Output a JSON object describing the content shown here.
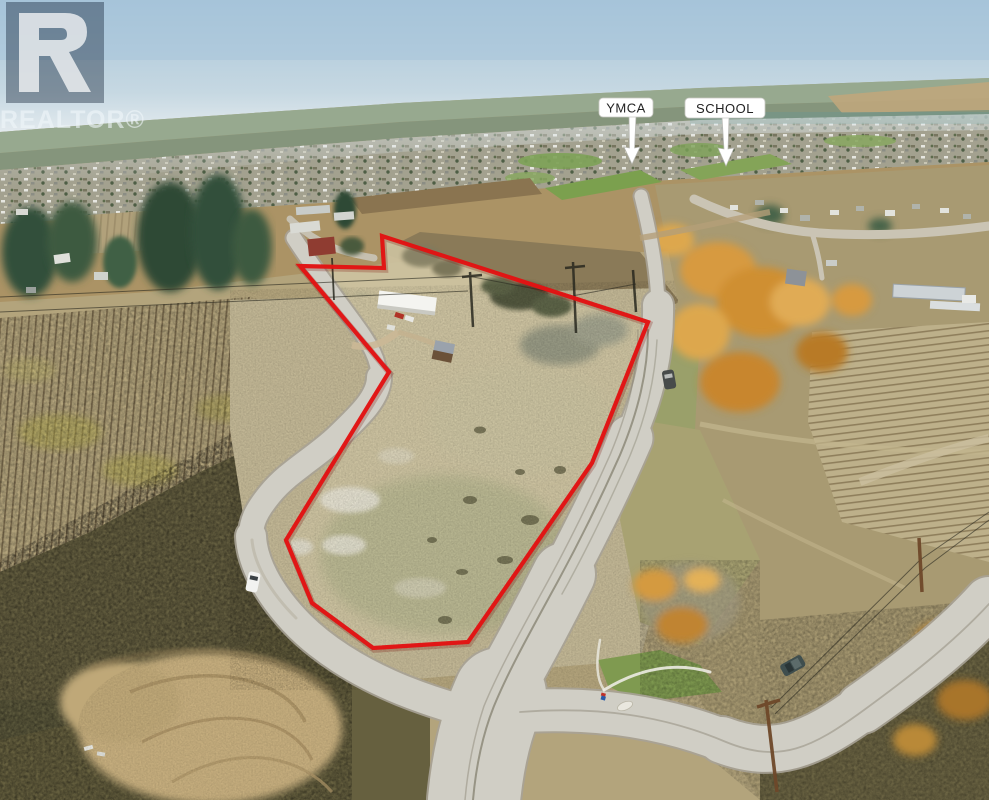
{
  "watermark": {
    "letter_icon": "realtor-R",
    "wordmark": "REALTOR®",
    "overlay_color": "#14283c",
    "text_color": "#f0f6fa"
  },
  "labels": {
    "bg": "#ffffff",
    "text_color": "#222222",
    "ymca": {
      "text": "YMCA"
    },
    "school": {
      "text": "SCHOOL"
    }
  },
  "boundary": {
    "color": "#e21313",
    "points": "300,266 384,268 382,236 648,322 592,463 468,642 373,648 312,603 286,540 389,372"
  }
}
